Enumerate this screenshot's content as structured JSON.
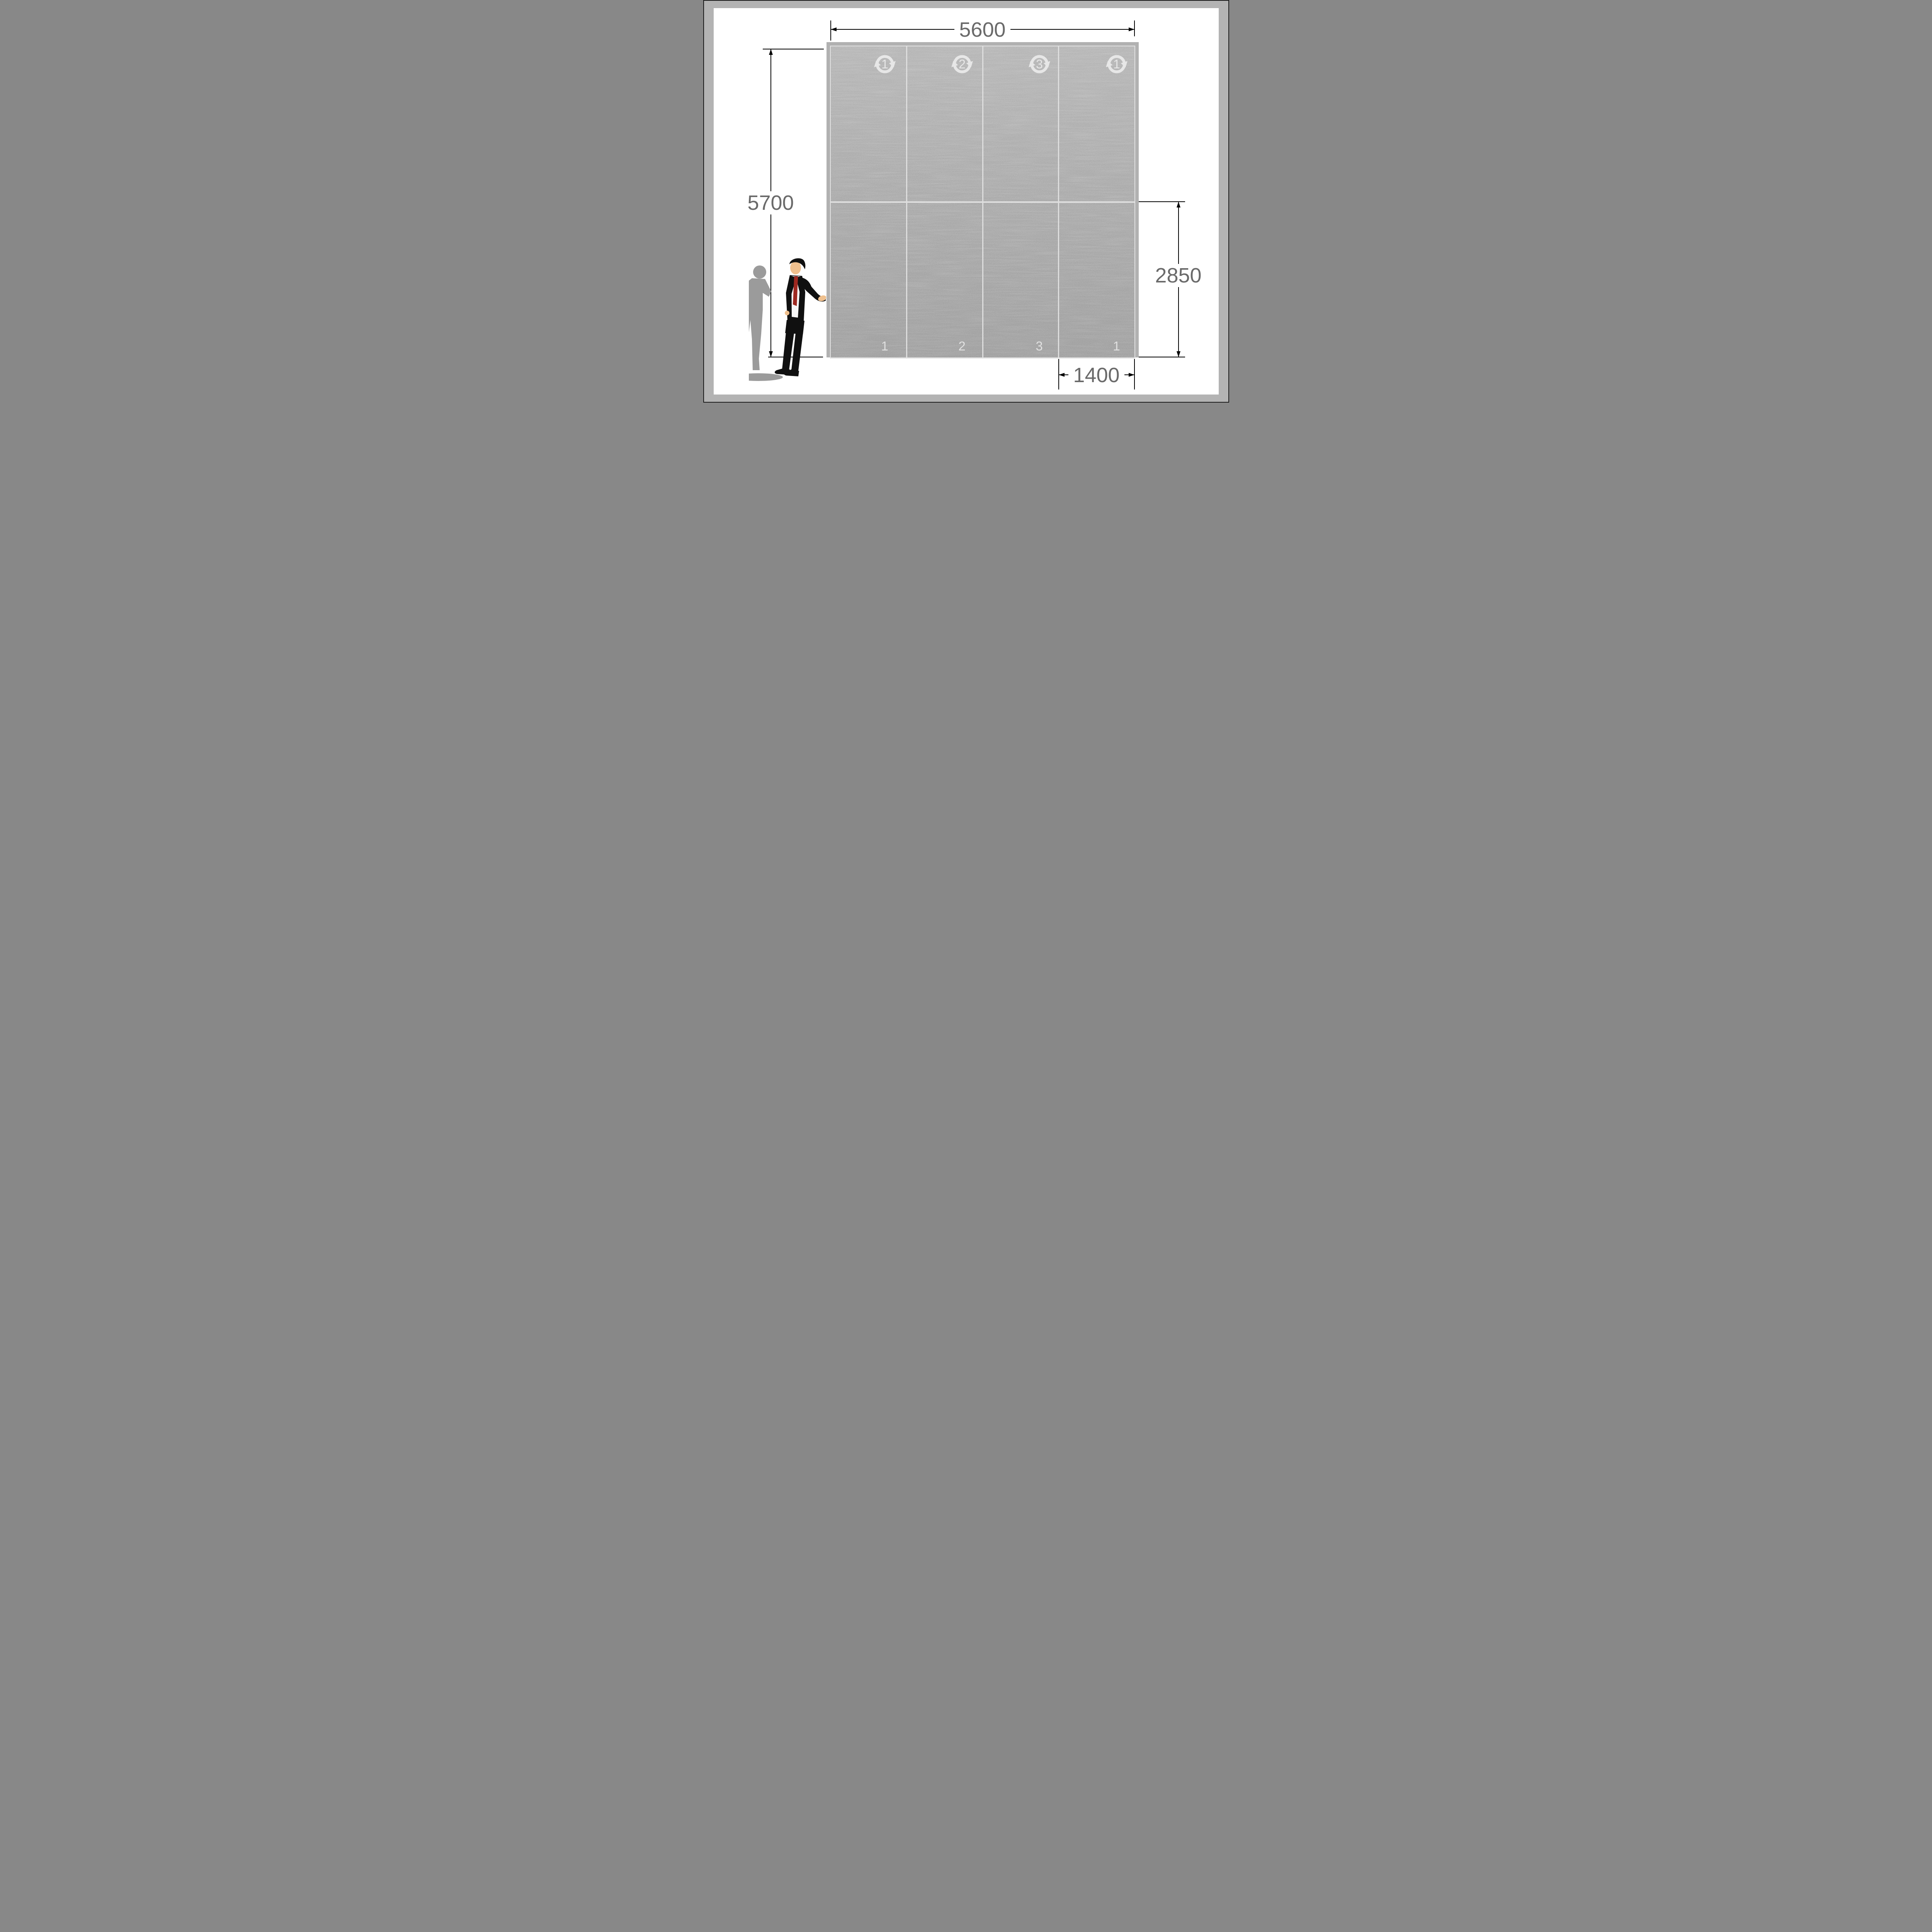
{
  "diagram": {
    "type": "wall-panel-elevation",
    "dimensions": {
      "total_width_mm": "5600",
      "total_height_mm": "5700",
      "lower_section_height_mm": "2850",
      "panel_width_mm": "1400"
    },
    "wall": {
      "panel_count": 4,
      "panels": [
        {
          "icon_number": "1",
          "bottom_label": "1"
        },
        {
          "icon_number": "2",
          "bottom_label": "2"
        },
        {
          "icon_number": "3",
          "bottom_label": "3"
        },
        {
          "icon_number": "1",
          "bottom_label": "1"
        }
      ]
    }
  },
  "colors": {
    "outline": "#1a1a1a",
    "page_frame": "#b3b3b3",
    "wall_frame": "#b1b1b1",
    "inner_border": "#e2e2e2",
    "concrete": "#a5a5a5",
    "joint": "#dedede",
    "icon": "#ebebeb",
    "panel_label": "#e9e9e9",
    "dim_text": "#6a6a6a",
    "suit": "#101010",
    "shirt": "#f7f7f7",
    "tie": "#9e2820",
    "skin": "#efc08e",
    "shadow": "#9b9b9b"
  }
}
